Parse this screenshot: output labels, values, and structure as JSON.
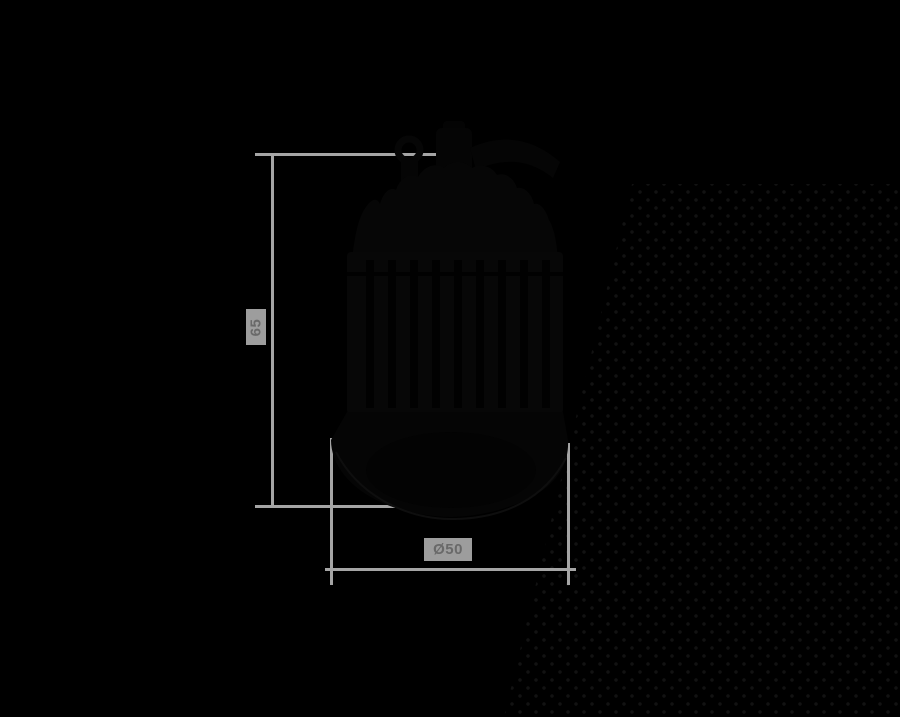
{
  "scene": {
    "background_color": "#000000"
  },
  "dimensions": {
    "line_color": "#a5a5a5",
    "label_bg_color": "#9d9d9d",
    "label_text_color": "#696969",
    "height": {
      "label": "65"
    },
    "diameter": {
      "label": "Ø50"
    }
  },
  "object": {
    "name": "black LED spotlight module silhouette",
    "body_color": "#060606"
  },
  "decoration": {
    "dot_color": "#121212"
  }
}
